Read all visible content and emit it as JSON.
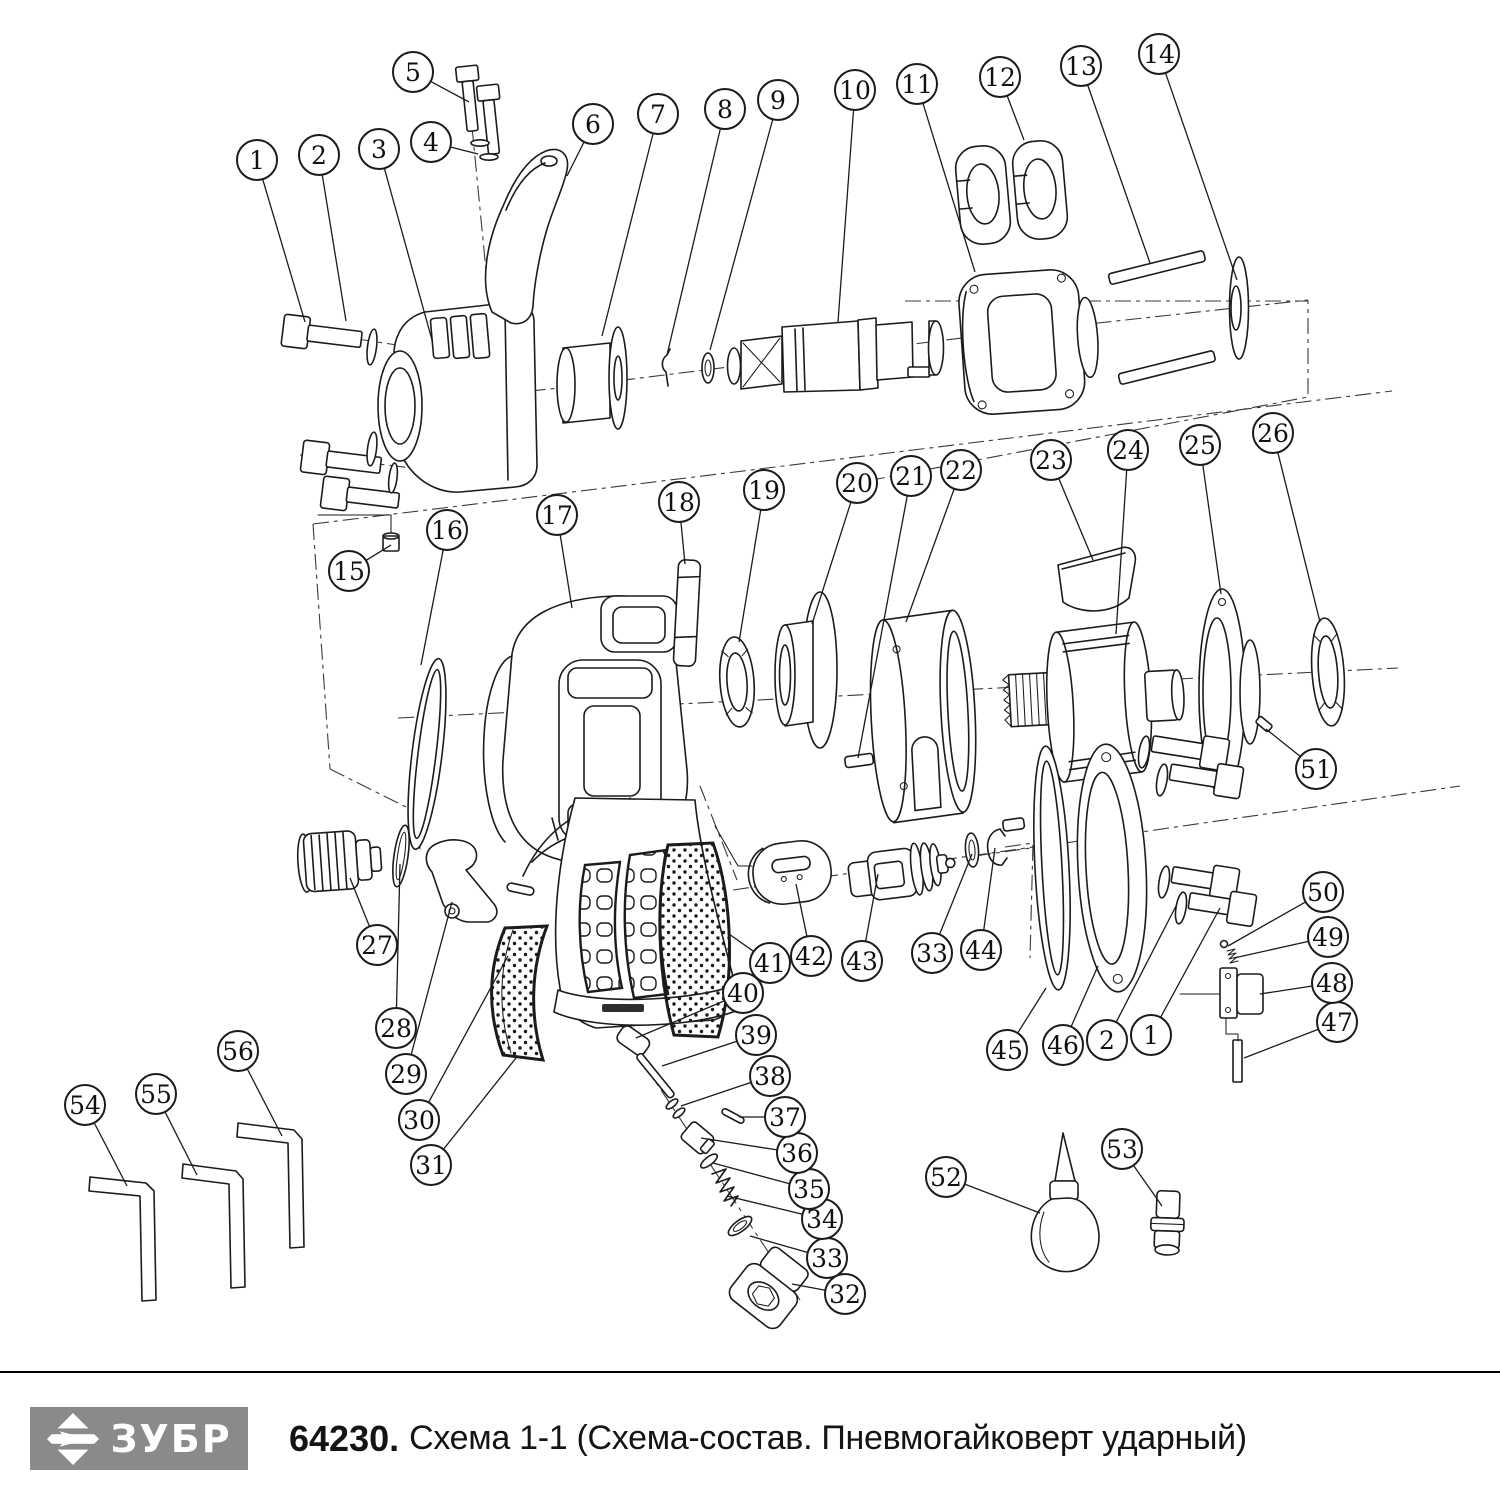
{
  "footer": {
    "logo": {
      "text": "ЗУБР",
      "bg_color": "#8a8a8a",
      "text_color": "#ffffff",
      "icon": "zubr-arrow-icon"
    },
    "code": "64230.",
    "title": "Схема 1-1 (Схема-состав. Пневмогайковерт ударный)"
  },
  "diagram": {
    "type": "exploded-parts-diagram",
    "subject": "Пневмогайковерт ударный",
    "callout_style": {
      "radius": 20,
      "stroke": "#1b1b1b",
      "font_size": 25
    },
    "callouts": [
      {
        "label": "1",
        "cx": 257,
        "cy": 160,
        "tx": 305,
        "ty": 322
      },
      {
        "label": "2",
        "cx": 319,
        "cy": 155,
        "tx": 346,
        "ty": 321
      },
      {
        "label": "3",
        "cx": 379,
        "cy": 149,
        "tx": 432,
        "ty": 340
      },
      {
        "label": "4",
        "cx": 431,
        "cy": 142,
        "tx": 478,
        "ty": 154
      },
      {
        "label": "5",
        "cx": 413,
        "cy": 72,
        "tx": 469,
        "ty": 102
      },
      {
        "label": "6",
        "cx": 593,
        "cy": 124,
        "tx": 567,
        "ty": 176
      },
      {
        "label": "7",
        "cx": 658,
        "cy": 114,
        "tx": 602,
        "ty": 336
      },
      {
        "label": "8",
        "cx": 725,
        "cy": 109,
        "tx": 667,
        "ty": 355
      },
      {
        "label": "9",
        "cx": 778,
        "cy": 100,
        "tx": 710,
        "ty": 350
      },
      {
        "label": "10",
        "cx": 855,
        "cy": 90,
        "tx": 838,
        "ty": 322
      },
      {
        "label": "11",
        "cx": 917,
        "cy": 84,
        "tx": 975,
        "ty": 272
      },
      {
        "label": "12",
        "cx": 1000,
        "cy": 77,
        "tx": 1024,
        "ty": 140
      },
      {
        "label": "13",
        "cx": 1081,
        "cy": 66,
        "tx": 1150,
        "ty": 263
      },
      {
        "label": "14",
        "cx": 1159,
        "cy": 54,
        "tx": 1237,
        "ty": 280
      },
      {
        "label": "15",
        "cx": 349,
        "cy": 571,
        "tx": 391,
        "ty": 545
      },
      {
        "label": "16",
        "cx": 447,
        "cy": 530,
        "tx": 421,
        "ty": 665
      },
      {
        "label": "17",
        "cx": 557,
        "cy": 515,
        "tx": 572,
        "ty": 608
      },
      {
        "label": "18",
        "cx": 679,
        "cy": 502,
        "tx": 685,
        "ty": 564
      },
      {
        "label": "19",
        "cx": 764,
        "cy": 490,
        "tx": 739,
        "ty": 642
      },
      {
        "label": "20",
        "cx": 857,
        "cy": 483,
        "tx": 812,
        "ty": 624
      },
      {
        "label": "21",
        "cx": 911,
        "cy": 476,
        "tx": 858,
        "ty": 758
      },
      {
        "label": "22",
        "cx": 961,
        "cy": 470,
        "tx": 906,
        "ty": 622
      },
      {
        "label": "23",
        "cx": 1051,
        "cy": 460,
        "tx": 1093,
        "ty": 560
      },
      {
        "label": "24",
        "cx": 1128,
        "cy": 450,
        "tx": 1116,
        "ty": 634
      },
      {
        "label": "25",
        "cx": 1200,
        "cy": 445,
        "tx": 1221,
        "ty": 594
      },
      {
        "label": "26",
        "cx": 1273,
        "cy": 433,
        "tx": 1320,
        "ty": 622
      },
      {
        "label": "27",
        "cx": 377,
        "cy": 945,
        "tx": 350,
        "ty": 878
      },
      {
        "label": "28",
        "cx": 396,
        "cy": 1028,
        "tx": 400,
        "ty": 864
      },
      {
        "label": "29",
        "cx": 406,
        "cy": 1074,
        "tx": 452,
        "ty": 902
      },
      {
        "label": "30",
        "cx": 419,
        "cy": 1120,
        "tx": 508,
        "ty": 956
      },
      {
        "label": "31",
        "cx": 431,
        "cy": 1165,
        "tx": 516,
        "ty": 1058
      },
      {
        "label": "32",
        "cx": 845,
        "cy": 1294,
        "tx": 792,
        "ty": 1284
      },
      {
        "label": "33",
        "cx": 827,
        "cy": 1258,
        "tx": 750,
        "ty": 1236
      },
      {
        "label": "34",
        "cx": 822,
        "cy": 1219,
        "tx": 727,
        "ty": 1196
      },
      {
        "label": "35",
        "cx": 809,
        "cy": 1189,
        "tx": 713,
        "ty": 1163
      },
      {
        "label": "36",
        "cx": 797,
        "cy": 1153,
        "tx": 701,
        "ty": 1138
      },
      {
        "label": "37",
        "cx": 785,
        "cy": 1117,
        "tx": 739,
        "ty": 1117
      },
      {
        "label": "38",
        "cx": 770,
        "cy": 1076,
        "tx": 681,
        "ty": 1106
      },
      {
        "label": "39",
        "cx": 756,
        "cy": 1035,
        "tx": 662,
        "ty": 1066
      },
      {
        "label": "40",
        "cx": 743,
        "cy": 993,
        "tx": 636,
        "ty": 1038
      },
      {
        "label": "41",
        "cx": 770,
        "cy": 963,
        "tx": 729,
        "ty": 934
      },
      {
        "label": "42",
        "cx": 811,
        "cy": 956,
        "tx": 796,
        "ty": 884
      },
      {
        "label": "43",
        "cx": 862,
        "cy": 961,
        "tx": 878,
        "ty": 874
      },
      {
        "label": "33",
        "cx": 932,
        "cy": 953,
        "tx": 972,
        "ty": 854
      },
      {
        "label": "44",
        "cx": 981,
        "cy": 950,
        "tx": 995,
        "ty": 848
      },
      {
        "label": "45",
        "cx": 1007,
        "cy": 1050,
        "tx": 1046,
        "ty": 988
      },
      {
        "label": "46",
        "cx": 1063,
        "cy": 1045,
        "tx": 1098,
        "ty": 966
      },
      {
        "label": "2",
        "cx": 1107,
        "cy": 1040,
        "tx": 1176,
        "ty": 906
      },
      {
        "label": "1",
        "cx": 1151,
        "cy": 1035,
        "tx": 1220,
        "ty": 908
      },
      {
        "label": "47",
        "cx": 1337,
        "cy": 1022,
        "tx": 1244,
        "ty": 1058
      },
      {
        "label": "48",
        "cx": 1332,
        "cy": 983,
        "tx": 1260,
        "ty": 994
      },
      {
        "label": "49",
        "cx": 1328,
        "cy": 937,
        "tx": 1234,
        "ty": 958
      },
      {
        "label": "50",
        "cx": 1323,
        "cy": 892,
        "tx": 1228,
        "ty": 946
      },
      {
        "label": "51",
        "cx": 1316,
        "cy": 769,
        "tx": 1266,
        "ty": 729
      },
      {
        "label": "52",
        "cx": 946,
        "cy": 1177,
        "tx": 1040,
        "ty": 1213
      },
      {
        "label": "53",
        "cx": 1122,
        "cy": 1149,
        "tx": 1162,
        "ty": 1206
      },
      {
        "label": "54",
        "cx": 85,
        "cy": 1105,
        "tx": 127,
        "ty": 1186
      },
      {
        "label": "55",
        "cx": 156,
        "cy": 1094,
        "tx": 197,
        "ty": 1175
      },
      {
        "label": "56",
        "cx": 238,
        "cy": 1051,
        "tx": 282,
        "ty": 1136
      }
    ]
  }
}
